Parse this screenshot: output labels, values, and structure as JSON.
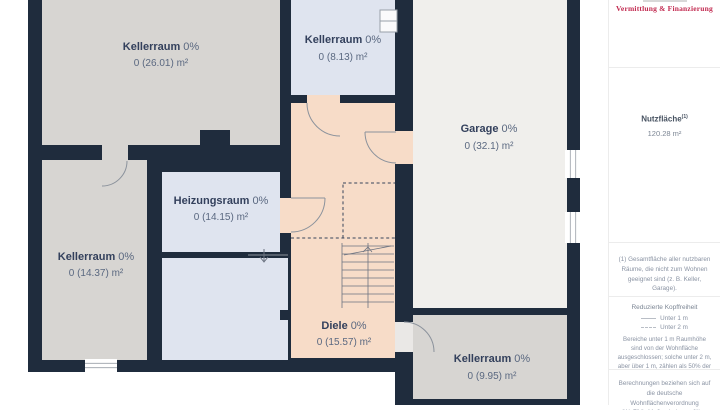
{
  "plan": {
    "rooms": [
      {
        "name": "Kellerraum",
        "pct": "0%",
        "area": "0 (26.01) m²"
      },
      {
        "name": "Kellerraum",
        "pct": "0%",
        "area": "0 (8.13) m²"
      },
      {
        "name": "Garage",
        "pct": "0%",
        "area": "0 (32.1) m²"
      },
      {
        "name": "Heizungsraum",
        "pct": "0%",
        "area": "0 (14.15) m²"
      },
      {
        "name": "Kellerraum",
        "pct": "0%",
        "area": "0 (14.37) m²"
      },
      {
        "name": "Diele",
        "pct": "0%",
        "area": "0 (15.57) m²"
      },
      {
        "name": "Kellerraum",
        "pct": "0%",
        "area": "0 (9.95) m²"
      }
    ],
    "colors": {
      "wall": "#1f2c3d",
      "floor_grey": "#d7d5d2",
      "floor_blue": "#dfe4ef",
      "floor_peach": "#f7dcc8",
      "floor_garage": "#f0efec"
    }
  },
  "sidebar": {
    "brand_tagline": "Vermittlung & Finanzierung",
    "accent_color": "#c22a50",
    "usable_area_label": "Nutzfläche",
    "usable_area_sup": "(1)",
    "usable_area_value": "120.28 m²",
    "footnote": "(1) Gesamtfläche aller nutzbaren Räume, die nicht zum Wohnen geeignet sind (z. B. Keller, Garage).",
    "legend_title": "Reduzierte Kopffreiheit",
    "legend_items": [
      {
        "label": "Unter 1 m",
        "style": "solid"
      },
      {
        "label": "Unter 2 m",
        "style": "dashed"
      }
    ],
    "legend_note": "Bereiche unter 1 m Raumhöhe sind von der Wohnfläche ausgeschlossen; solche unter 2 m, aber über 1 m, zählen als 50% der Wohnfläche",
    "disclaimer": "Berechnungen beziehen sich auf die deutsche Wohnflächenverordnung (WoFlV). Maße sind ungefähre Angaben"
  }
}
